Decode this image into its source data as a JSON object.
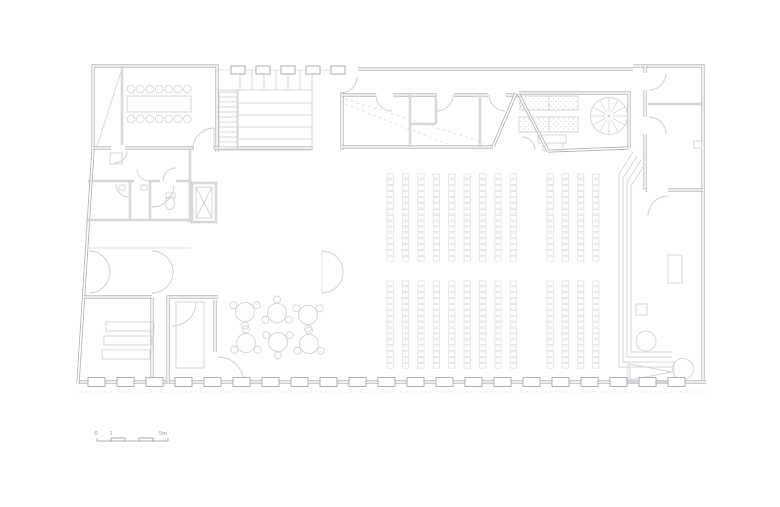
{
  "drawing": {
    "kind": "architectural-floor-plan",
    "background": "#ffffff"
  },
  "colors": {
    "wall": "#aab0b3",
    "wall_core": "#ffffff",
    "line_light": "#d4d7d9",
    "line_faint": "#e4e6e7",
    "seat": "#e0e2e4",
    "arc": "#c9cdd0",
    "stipple": "#c6cacc",
    "text": "#8f9497"
  },
  "scale_bar": {
    "labels": {
      "zero": "0",
      "one": "1",
      "five": "5m"
    }
  },
  "seating": {
    "left_block_columns": 9,
    "right_block_columns": 4,
    "rows_per_block": 15,
    "row_blocks": 2
  },
  "cafe": {
    "tables": 6,
    "chairs_per_table": 3
  },
  "meeting_room": {
    "chairs_per_side": 7,
    "sides": 2
  },
  "facade": {
    "bottom_pilasters": 21,
    "top_pilasters": 5
  },
  "spiral_stair": {
    "spokes": 12
  },
  "stairs": {
    "treads": 11,
    "upper_ticks": 7,
    "landing_lines": 4
  },
  "trapezoid_room": {
    "bars": 3
  }
}
